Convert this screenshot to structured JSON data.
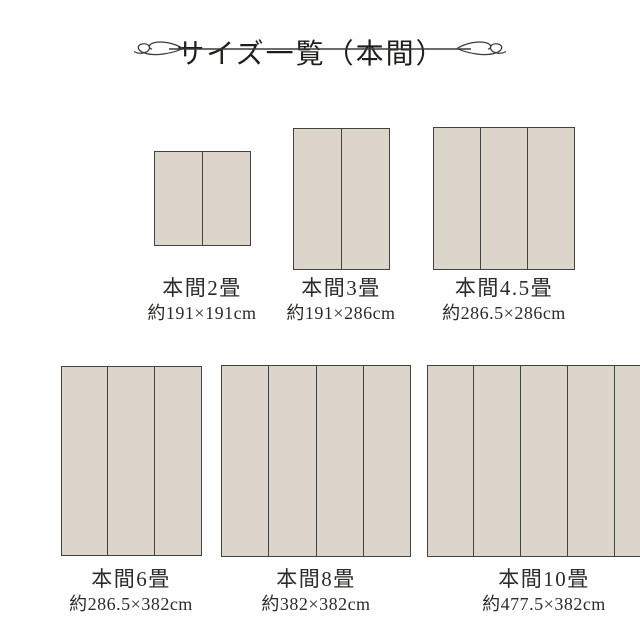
{
  "header": {
    "title": "サイズ一覧（本間）"
  },
  "colors": {
    "mat_fill": "#dcd5cb",
    "mat_border": "#45423c",
    "text_color": "#2d2b27",
    "line_color": "#3a3a38"
  },
  "mats": [
    {
      "name": "本間2畳",
      "size": "約191×191cm",
      "panels": 2
    },
    {
      "name": "本間3畳",
      "size": "約191×286cm",
      "panels": 2
    },
    {
      "name": "本間4.5畳",
      "size": "約286.5×286cm",
      "panels": 3
    },
    {
      "name": "本間6畳",
      "size": "約286.5×382cm",
      "panels": 3
    },
    {
      "name": "本間8畳",
      "size": "約382×382cm",
      "panels": 4
    },
    {
      "name": "本間10畳",
      "size": "約477.5×382cm",
      "panels": 5
    }
  ]
}
